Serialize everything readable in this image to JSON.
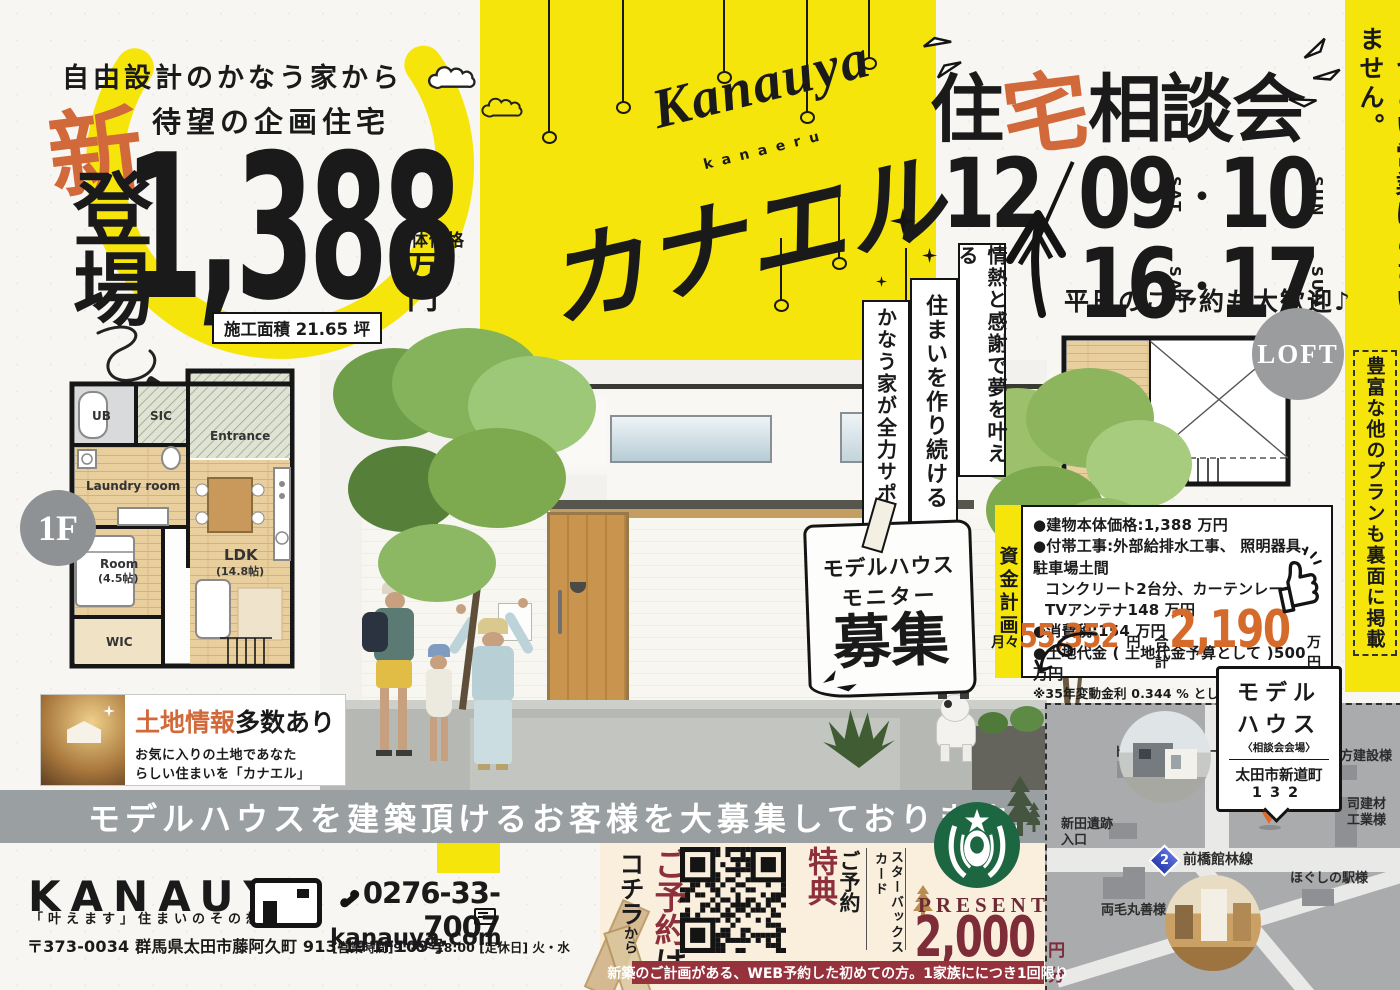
{
  "header_left": {
    "tagline1": "自由設計のかなう家から",
    "tagline2": "待望の企画住宅",
    "new_kanji": "新",
    "debut": "登場",
    "price": "1,388",
    "price_label": "本体価格",
    "price_unit": "万円",
    "area_badge": "施工面積 21.65 坪"
  },
  "brand": {
    "script": "Kanauya",
    "script_sub": "kanaeru",
    "katakana": "カナエル"
  },
  "event": {
    "title_pre": "住",
    "title_accent": "宅",
    "title_post": "相談会",
    "month": "12",
    "d1": "09",
    "d1_dow": "SAT",
    "d2": "10",
    "d2_dow": "SUN",
    "d3": "16",
    "d3_dow": "SAT",
    "d4": "17",
    "d4_dow": "SUN",
    "dot": "・",
    "note": "平日のご予約も大歓迎♪"
  },
  "strip": {
    "main": "しつこい営業はございません。",
    "boxed": "豊富な他のプランも裏面に掲載"
  },
  "slogans": {
    "s1": "情熱と感謝で夢を叶える",
    "s2": "住まいを作り続ける",
    "s3": "かなう家が全力サポート"
  },
  "plan1f": {
    "badge": "1F",
    "ub": "UB",
    "sic": "SIC",
    "entrance": "Entrance",
    "laundry": "Laundry room",
    "ldk": "LDK",
    "ldk_size": "(14.8帖)",
    "room": "Room",
    "room_size": "(4.5帖)",
    "wic": "WIC"
  },
  "loft": {
    "badge": "LOFT",
    "name": "Loft",
    "size": "(7.5帖)",
    "dn": "DN"
  },
  "land": {
    "accent": "土地情報",
    "bold": "多数あり",
    "l1": "お気に入りの土地であなた",
    "l2": "らしい住まいを「カナエル」"
  },
  "monitor": {
    "l1": "モデルハウス",
    "l2": "モニター",
    "l3": "募集"
  },
  "funding": {
    "tab": "資金計画",
    "i1": "●建物本体価格:1,388 万円",
    "i2": "●付帯工事:外部給排水工事、 照明器具、 駐車場土間",
    "i3": "コンクリート2台分、カーテンレール、TVアンテナ148 万円",
    "i4": "●消費税:154 万円",
    "i5": "●土地代金 ( 土地代金予算として )500 万円",
    "i6": "※35年変動金利 0.344 % として ( 住信 SBI)",
    "m_label": "月々",
    "m_val": "55,352",
    "m_unit": "円",
    "t_label": "合計",
    "t_val": "2,190",
    "t_unit": "万円"
  },
  "map": {
    "c1": "モデル",
    "c2": "ハウス",
    "c_sub": "〈相談会会場〉",
    "c_addr1": "太田市新道町",
    "c_addr2": "132",
    "toyota": "トヨタレンタカー様",
    "nitta1": "新田遺跡",
    "nitta2": "入口",
    "ubukata": "生方建設様",
    "tsukasa1": "司建材",
    "tsukasa2": "工業様",
    "route": "2",
    "road": "前橋館林線",
    "ryomo": "両毛丸善様",
    "hogushi": "ほぐしの駅様"
  },
  "banner": {
    "text": "モデルハウスを建築頂けるお客様を大募集しております♪"
  },
  "company": {
    "name": "KANAUYA",
    "slogan": "「叶えます」住まいのその想い",
    "phone": "0276-33-7007",
    "web": "kanauya.com",
    "address": "〒373-0034 群馬県太田市藤阿久町 913-19 1F109号",
    "hours": "[営業時間]9:00~18:00 [定休日] 火・水"
  },
  "coupon": {
    "cta_red": "ご予約",
    "cta_black": "は",
    "cta2": "コチラ",
    "cta2_small": "から",
    "bonus_black": "ご予約",
    "bonus_red": "特典",
    "card1": "スターバックス",
    "card2": "カード",
    "present": "PRESENT",
    "amount": "2,000",
    "amount_unit": "円分",
    "terms": "新築のご計画がある、WEB予約した初めての方。1家族ににつき1回限り"
  }
}
